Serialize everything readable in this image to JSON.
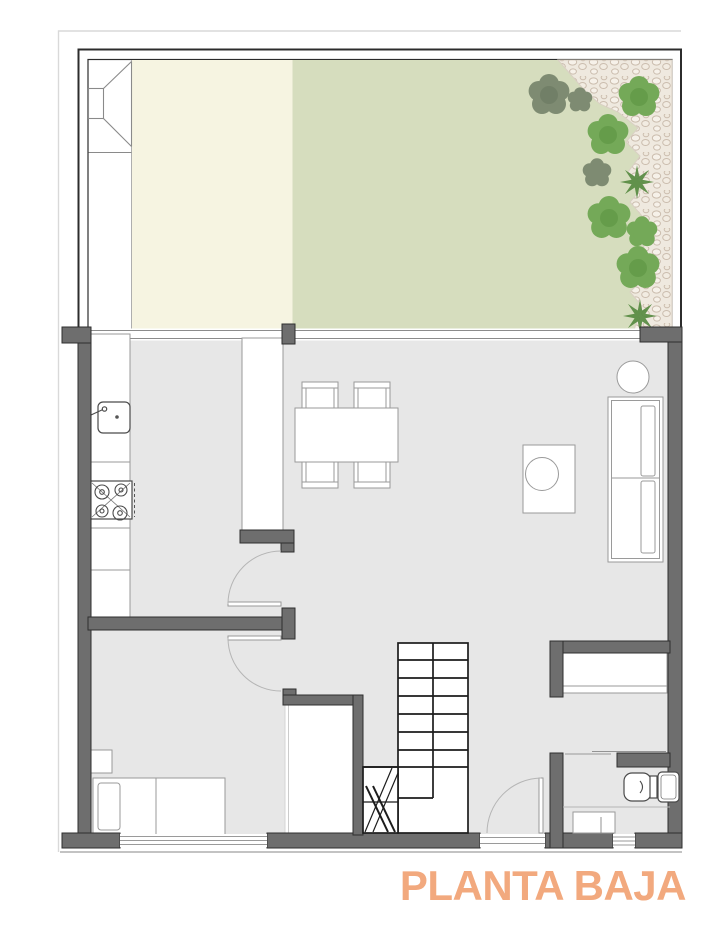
{
  "title": {
    "label": "PLANTA BAJA"
  },
  "palette": {
    "paper": "#ffffff",
    "accent": "#f2a97e",
    "wall": "#6e6e6e",
    "wall_edge": "#2f2f2f",
    "floor": "#e7e7e7",
    "terrace": "#f6f4e1",
    "lawn": "#d6ddbe",
    "gravel": "#efe9df",
    "stone": "#cbbdae",
    "plant": "#74a958",
    "plant_dark": "#7e8b72",
    "palm": "#578a41",
    "line": "#9a9a9a",
    "outline": "#1c1c1c"
  },
  "plan": {
    "garden_features": [
      "lawn",
      "paved-terrace",
      "side-path",
      "gravel-path",
      "shrubs",
      "palm-plants",
      "garden-gate-funnel"
    ],
    "rooms": [
      "garden",
      "kitchen",
      "dining-area",
      "living-area",
      "hallway",
      "bedroom",
      "storage-closet",
      "stairs",
      "dressing-room",
      "bathroom"
    ],
    "furniture": [
      "kitchen-counter",
      "sink",
      "stove",
      "tall-cabinet",
      "dining-table",
      "chairs",
      "round-side-table",
      "sofa",
      "coffee-table",
      "bed",
      "nightstand",
      "wardrobe",
      "toilet",
      "washbasin",
      "shower-tray"
    ],
    "openings": [
      "facade-glazing",
      "bedroom-window",
      "bathroom-window",
      "entrance-door",
      "hall-door",
      "bedroom-door"
    ]
  }
}
